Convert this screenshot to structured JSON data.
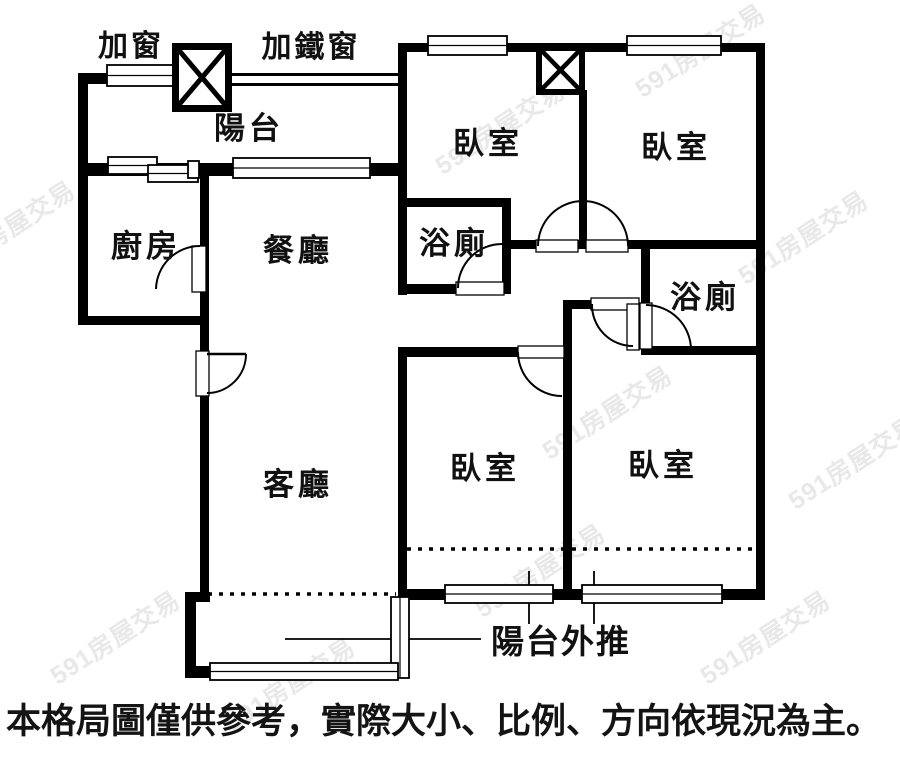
{
  "rooms": [
    {
      "id": "balcony",
      "label": "陽台"
    },
    {
      "id": "kitchen",
      "label": "廚房"
    },
    {
      "id": "dining",
      "label": "餐廳"
    },
    {
      "id": "living",
      "label": "客廳"
    },
    {
      "id": "bedroom-top-left",
      "label": "臥室"
    },
    {
      "id": "bedroom-top-right",
      "label": "臥室"
    },
    {
      "id": "bedroom-bottom-left",
      "label": "臥室"
    },
    {
      "id": "bedroom-bottom-right",
      "label": "臥室"
    },
    {
      "id": "bathroom-upper",
      "label": "浴廁"
    },
    {
      "id": "bathroom-lower",
      "label": "浴廁"
    }
  ],
  "annotations": {
    "add_window": "加窗",
    "add_iron_window": "加鐵窗",
    "balcony_pushed_out": "陽台外推"
  },
  "disclaimer": "本格局圖僅供參考，實際大小、比例、方向依現況為主。",
  "watermark": "591房屋交易",
  "colors": {
    "wall": "#000000",
    "background": "#ffffff",
    "watermark": "#d9d9d9",
    "text": "#111111"
  }
}
